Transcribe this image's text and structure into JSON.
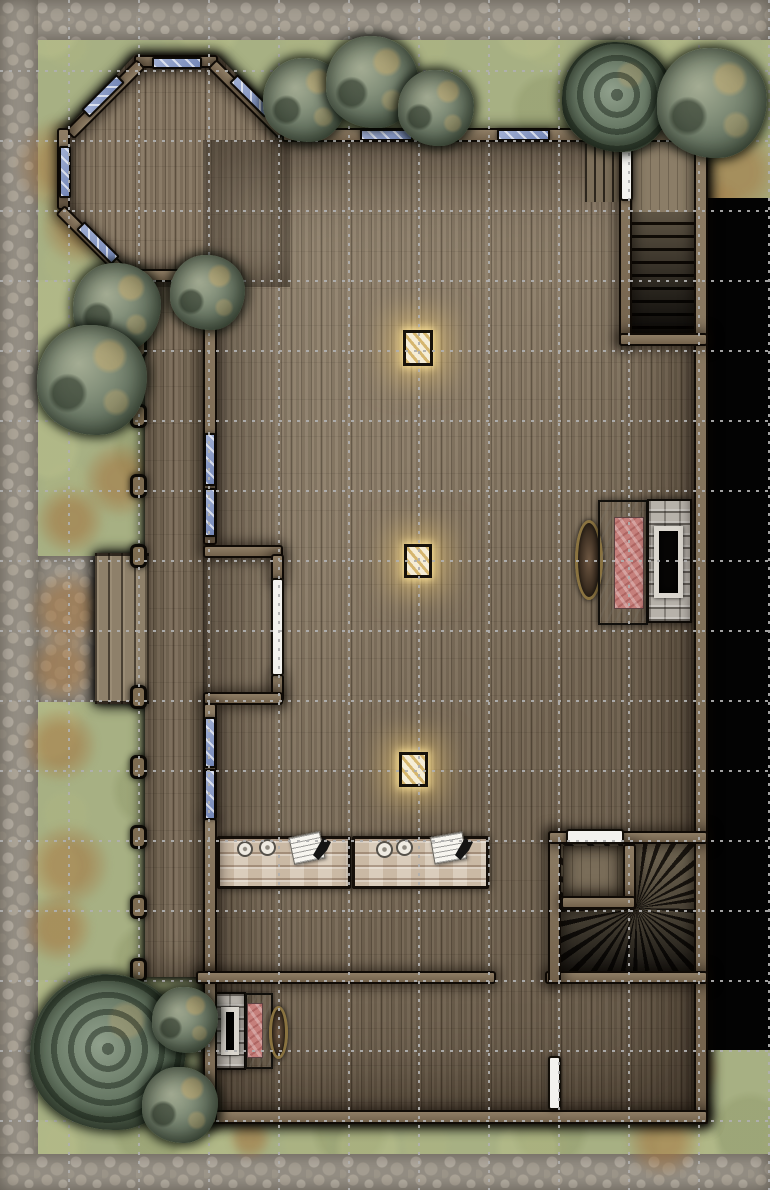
{
  "map": {
    "kind": "top-down fantasy battle map of a wooden manor interior",
    "size": {
      "width": 770,
      "height": 1190
    },
    "grid": {
      "cell": 70,
      "first_vertical_x": 68,
      "first_horizontal_y": 70,
      "width": 770,
      "height": 1190,
      "color": "#b0b0b0",
      "style": "dotted"
    },
    "palette": {
      "grass": "#a7b083",
      "stone_path": "#948e84",
      "dirt": "#a4743e",
      "wood_floor": "#82735f",
      "wall": "#7e6d55",
      "window_glass": "#8ea0c8",
      "door": "#f3f2ee",
      "table_wood": "#d5c6b3",
      "blanket_red": "#c57f7b",
      "void_black": "#030303",
      "lantern_glow": "#ffd878",
      "tree_green": "#6d7b68"
    },
    "summary": {
      "windows": 11,
      "doors": 4,
      "lanterns": 3,
      "tables": 2,
      "fireplaces_with_beds": 2,
      "trees_and_bushes": 12,
      "porch_posts": 10,
      "straight_staircase": 1,
      "winder_staircase": 1,
      "octagonal_bay": 1
    },
    "layers": {
      "stone": [
        {
          "name": "stone-path-top",
          "x": 0,
          "y": 0,
          "w": 770,
          "h": 40
        },
        {
          "name": "stone-path-left",
          "x": 0,
          "y": 0,
          "w": 38,
          "h": 1190
        },
        {
          "name": "stone-path-bottom",
          "x": 0,
          "y": 1154,
          "w": 770,
          "h": 36
        },
        {
          "name": "stone-walkway",
          "x": 38,
          "y": 556,
          "w": 58,
          "h": 146
        }
      ],
      "dirt": [
        {
          "name": "dirt-patch",
          "x": 14,
          "y": 117,
          "w": 96,
          "h": 96
        },
        {
          "name": "dirt-patch",
          "x": 40,
          "y": 185,
          "w": 80,
          "h": 80
        },
        {
          "name": "dirt-patch",
          "x": 75,
          "y": 185,
          "w": 60,
          "h": 60
        },
        {
          "name": "dirt-patch",
          "x": 687,
          "y": 124,
          "w": 96,
          "h": 96
        },
        {
          "name": "dirt-patch",
          "x": 677,
          "y": 180,
          "w": 70,
          "h": 70
        },
        {
          "name": "dirt-patch",
          "x": 82,
          "y": 442,
          "w": 76,
          "h": 76
        },
        {
          "name": "dirt-patch",
          "x": 35,
          "y": 485,
          "w": 70,
          "h": 70
        },
        {
          "name": "dirt-patch",
          "x": 28,
          "y": 570,
          "w": 80,
          "h": 80
        },
        {
          "name": "dirt-patch",
          "x": 27,
          "y": 633,
          "w": 70,
          "h": 70
        },
        {
          "name": "dirt-patch",
          "x": 22,
          "y": 707,
          "w": 76,
          "h": 76
        },
        {
          "name": "dirt-patch",
          "x": 26,
          "y": 823,
          "w": 84,
          "h": 84
        },
        {
          "name": "dirt-patch",
          "x": 23,
          "y": 893,
          "w": 70,
          "h": 70
        },
        {
          "name": "dirt-patch",
          "x": 625,
          "y": 1102,
          "w": 76,
          "h": 76
        },
        {
          "name": "dirt-patch",
          "x": 664,
          "y": 1040,
          "w": 56,
          "h": 56
        },
        {
          "name": "dirt-patch",
          "x": 228,
          "y": 1116,
          "w": 44,
          "h": 44
        }
      ],
      "floors": [
        {
          "name": "floor-bay",
          "cls": "floor",
          "x": 57,
          "y": 55,
          "w": 233,
          "h": 232,
          "clip": "polygon(78px 0px,160px 0px,233px 73px,233px 232px,92px 232px,92px 222px,70px 222px,8px 150px,8px 76px)"
        },
        {
          "name": "floor-great-hall",
          "cls": "floor",
          "x": 203,
          "y": 140,
          "w": 505,
          "h": 984
        },
        {
          "name": "floor-porch-deck",
          "cls": "floor",
          "x": 145,
          "y": 275,
          "w": 62,
          "h": 702
        },
        {
          "name": "porch-steps",
          "cls": "steps-porch",
          "x": 95,
          "y": 553,
          "w": 54,
          "h": 151
        }
      ],
      "void": [
        {
          "name": "unexplored-void",
          "cls": "void",
          "x": 706,
          "y": 198,
          "w": 64,
          "h": 852
        }
      ],
      "shades": [
        {
          "name": "hall-lighting",
          "cls": "shade-hall",
          "x": 203,
          "y": 140,
          "w": 505,
          "h": 984
        },
        {
          "name": "deck-shading",
          "cls": "shade-soft",
          "x": 145,
          "y": 275,
          "w": 62,
          "h": 702
        },
        {
          "name": "bay-shading",
          "cls": "shade-soft",
          "x": 57,
          "y": 55,
          "w": 233,
          "h": 232,
          "clip": "polygon(78px 0px,160px 0px,233px 73px,233px 232px,92px 232px,92px 222px,70px 222px,8px 150px,8px 76px)"
        }
      ],
      "stairs": [
        {
          "name": "stair-side-steps",
          "cls": "stairs-side",
          "x": 585,
          "y": 144,
          "w": 36,
          "h": 58
        },
        {
          "name": "stair-landing",
          "cls": "stairs-landing",
          "x": 632,
          "y": 142,
          "w": 62,
          "h": 70
        },
        {
          "name": "staircase-down",
          "cls": "stairs-steps",
          "x": 632,
          "y": 212,
          "w": 62,
          "h": 121
        },
        {
          "name": "winder-staircase",
          "cls": "fan",
          "x": 561,
          "y": 844,
          "w": 137,
          "h": 128
        },
        {
          "name": "closet-floor",
          "cls": "closet-floor",
          "x": 563,
          "y": 846,
          "w": 60,
          "h": 50
        }
      ],
      "furniture": [
        {
          "name": "long-table",
          "cls": "table",
          "x": 217,
          "y": 836,
          "w": 134,
          "h": 53
        },
        {
          "name": "long-table",
          "cls": "table",
          "x": 352,
          "y": 836,
          "w": 137,
          "h": 53
        },
        {
          "name": "plate",
          "cls": "plate",
          "x": 237,
          "y": 841,
          "w": 16,
          "h": 16
        },
        {
          "name": "plate",
          "cls": "plate",
          "x": 259,
          "y": 839,
          "w": 17,
          "h": 17
        },
        {
          "name": "plate",
          "cls": "plate",
          "x": 376,
          "y": 841,
          "w": 17,
          "h": 17
        },
        {
          "name": "plate",
          "cls": "plate",
          "x": 396,
          "y": 839,
          "w": 17,
          "h": 17
        },
        {
          "name": "papers",
          "cls": "paper",
          "x": 291,
          "y": 834,
          "w": 32,
          "h": 28,
          "rot": -12
        },
        {
          "name": "papers",
          "cls": "paper",
          "x": 432,
          "y": 834,
          "w": 33,
          "h": 28,
          "rot": -10
        },
        {
          "name": "quill",
          "cls": "quill",
          "x": 313,
          "y": 838,
          "w": 18,
          "h": 22
        },
        {
          "name": "quill",
          "cls": "quill",
          "x": 455,
          "y": 838,
          "w": 18,
          "h": 22
        },
        {
          "name": "wall-ornament",
          "cls": "decor",
          "x": 575,
          "y": 520,
          "w": 28,
          "h": 80
        },
        {
          "name": "bed-frame",
          "cls": "bedframe",
          "x": 598,
          "y": 500,
          "w": 50,
          "h": 125
        },
        {
          "name": "red-blanket",
          "cls": "blanket",
          "x": 614,
          "y": 517,
          "w": 30,
          "h": 92
        },
        {
          "name": "stone-fireplace",
          "cls": "hearth",
          "x": 647,
          "y": 499,
          "w": 45,
          "h": 124
        },
        {
          "name": "hearth-opening",
          "cls": "hearth-open",
          "x": 654,
          "y": 526,
          "w": 29,
          "h": 72
        },
        {
          "name": "stone-fireplace",
          "cls": "hearth",
          "x": 212,
          "y": 992,
          "w": 34,
          "h": 78
        },
        {
          "name": "hearth-opening",
          "cls": "hearth-open",
          "x": 221,
          "y": 1007,
          "w": 18,
          "h": 48
        },
        {
          "name": "bed-frame",
          "cls": "bedframe",
          "x": 245,
          "y": 993,
          "w": 28,
          "h": 76
        },
        {
          "name": "red-blanket",
          "cls": "blanket",
          "x": 247,
          "y": 1003,
          "w": 16,
          "h": 55
        },
        {
          "name": "wall-ornament",
          "cls": "decor",
          "x": 269,
          "y": 1006,
          "w": 19,
          "h": 53
        },
        {
          "name": "glowing-lantern",
          "cls": "lantern",
          "x": 403,
          "y": 330,
          "w": 30,
          "h": 36
        },
        {
          "name": "glowing-lantern",
          "cls": "lantern",
          "x": 404,
          "y": 544,
          "w": 28,
          "h": 34
        },
        {
          "name": "glowing-lantern",
          "cls": "lantern",
          "x": 399,
          "y": 752,
          "w": 29,
          "h": 35
        }
      ],
      "walls": [
        {
          "name": "bay-wall-north",
          "x": 134,
          "y": 55,
          "w": 84,
          "h": 13
        },
        {
          "name": "bay-wall-ne-diagonal",
          "x": 212,
          "y": 57,
          "w": 101,
          "h": 13,
          "rot": 45,
          "origin": "0 50%"
        },
        {
          "name": "bay-wall-nw-diagonal",
          "x": 141,
          "y": 57,
          "w": 101,
          "h": 13,
          "rot": 135,
          "origin": "0 50%"
        },
        {
          "name": "bay-wall-west",
          "x": 57,
          "y": 128,
          "w": 13,
          "h": 82
        },
        {
          "name": "bay-wall-sw-diagonal",
          "x": 60,
          "y": 203,
          "w": 100,
          "h": 13,
          "rot": 45,
          "origin": "0 50%"
        },
        {
          "name": "bay-wall-south",
          "x": 126,
          "y": 269,
          "w": 90,
          "h": 13
        },
        {
          "name": "north-wall",
          "x": 282,
          "y": 128,
          "w": 426,
          "h": 14
        },
        {
          "name": "east-wall",
          "x": 694,
          "y": 128,
          "w": 14,
          "h": 996
        },
        {
          "name": "south-wall",
          "x": 196,
          "y": 1110,
          "w": 512,
          "h": 14
        },
        {
          "name": "west-wall-upper",
          "x": 203,
          "y": 275,
          "w": 14,
          "h": 270
        },
        {
          "name": "alcove-wall-top",
          "x": 203,
          "y": 545,
          "w": 80,
          "h": 13
        },
        {
          "name": "alcove-door-jamb",
          "x": 271,
          "y": 554,
          "w": 13,
          "h": 28
        },
        {
          "name": "alcove-door-jamb",
          "x": 271,
          "y": 674,
          "w": 13,
          "h": 28
        },
        {
          "name": "alcove-wall-bottom",
          "x": 203,
          "y": 692,
          "w": 80,
          "h": 13
        },
        {
          "name": "west-wall-mid",
          "x": 203,
          "y": 703,
          "w": 14,
          "h": 117
        },
        {
          "name": "west-wall-lower",
          "x": 203,
          "y": 818,
          "w": 14,
          "h": 157
        },
        {
          "name": "storeroom-west-wall",
          "x": 203,
          "y": 972,
          "w": 14,
          "h": 152
        },
        {
          "name": "cross-wall-west",
          "x": 196,
          "y": 971,
          "w": 300,
          "h": 13
        },
        {
          "name": "cross-wall-east",
          "x": 545,
          "y": 971,
          "w": 163,
          "h": 13
        },
        {
          "name": "stairroom-west-wall",
          "x": 548,
          "y": 831,
          "w": 13,
          "h": 153
        },
        {
          "name": "stairroom-north-wall",
          "x": 548,
          "y": 831,
          "w": 160,
          "h": 13
        },
        {
          "name": "closet-east-wall",
          "x": 623,
          "y": 844,
          "w": 13,
          "h": 66
        },
        {
          "name": "closet-south-wall",
          "x": 561,
          "y": 896,
          "w": 75,
          "h": 13
        },
        {
          "name": "stairshaft-west-wall",
          "x": 619,
          "y": 128,
          "w": 13,
          "h": 218
        },
        {
          "name": "stairshaft-south-wall",
          "x": 619,
          "y": 333,
          "w": 89,
          "h": 13
        }
      ],
      "doors": [
        {
          "name": "door-west-alcove",
          "cls": "door",
          "x": 271,
          "y": 578,
          "w": 13,
          "h": 98
        },
        {
          "name": "door-stair-landing",
          "cls": "door",
          "x": 620,
          "y": 144,
          "w": 13,
          "h": 57
        },
        {
          "name": "door-stair-room",
          "cls": "door",
          "x": 566,
          "y": 829,
          "w": 58,
          "h": 15
        },
        {
          "name": "door-store-room",
          "cls": "door",
          "x": 548,
          "y": 1056,
          "w": 13,
          "h": 54
        }
      ],
      "windows": [
        {
          "name": "window",
          "x": 152,
          "y": 57,
          "w": 50,
          "h": 12
        },
        {
          "name": "window",
          "x": 226,
          "y": 90,
          "w": 50,
          "h": 12,
          "rot": 45
        },
        {
          "name": "window",
          "x": 78,
          "y": 90,
          "w": 50,
          "h": 12,
          "rot": -45
        },
        {
          "name": "window",
          "x": 59,
          "y": 146,
          "w": 12,
          "h": 52
        },
        {
          "name": "window",
          "x": 73,
          "y": 237,
          "w": 50,
          "h": 12,
          "rot": 45
        },
        {
          "name": "window",
          "x": 360,
          "y": 129,
          "w": 53,
          "h": 12
        },
        {
          "name": "window",
          "x": 497,
          "y": 129,
          "w": 53,
          "h": 12
        },
        {
          "name": "window",
          "x": 204,
          "y": 433,
          "w": 12,
          "h": 53
        },
        {
          "name": "window",
          "x": 204,
          "y": 488,
          "w": 12,
          "h": 49
        },
        {
          "name": "window",
          "x": 204,
          "y": 717,
          "w": 12,
          "h": 51
        },
        {
          "name": "window",
          "x": 204,
          "y": 769,
          "w": 12,
          "h": 51
        }
      ],
      "posts": [
        {
          "name": "porch-post",
          "x": 130,
          "y": 283,
          "w": 17,
          "h": 24
        },
        {
          "name": "porch-post",
          "x": 130,
          "y": 334,
          "w": 17,
          "h": 24
        },
        {
          "name": "porch-post",
          "x": 130,
          "y": 404,
          "w": 17,
          "h": 24
        },
        {
          "name": "porch-post",
          "x": 130,
          "y": 474,
          "w": 17,
          "h": 24
        },
        {
          "name": "porch-post",
          "x": 130,
          "y": 544,
          "w": 17,
          "h": 24
        },
        {
          "name": "porch-post",
          "x": 130,
          "y": 685,
          "w": 17,
          "h": 24
        },
        {
          "name": "porch-post",
          "x": 130,
          "y": 755,
          "w": 17,
          "h": 24
        },
        {
          "name": "porch-post",
          "x": 130,
          "y": 825,
          "w": 17,
          "h": 24
        },
        {
          "name": "porch-post",
          "x": 130,
          "y": 895,
          "w": 17,
          "h": 24
        },
        {
          "name": "porch-post",
          "x": 130,
          "y": 958,
          "w": 17,
          "h": 24
        }
      ],
      "trees": [
        {
          "name": "bush",
          "cls": "tree bush",
          "x": 263,
          "y": 58,
          "w": 84,
          "h": 84
        },
        {
          "name": "bush",
          "cls": "tree bush",
          "x": 326,
          "y": 36,
          "w": 92,
          "h": 92
        },
        {
          "name": "bush",
          "cls": "tree bush",
          "x": 398,
          "y": 70,
          "w": 76,
          "h": 76
        },
        {
          "name": "tree",
          "cls": "tree swirl",
          "x": 562,
          "y": 42,
          "w": 110,
          "h": 110
        },
        {
          "name": "bush",
          "cls": "tree bush",
          "x": 657,
          "y": 48,
          "w": 110,
          "h": 110
        },
        {
          "name": "bush",
          "cls": "tree bush",
          "x": 73,
          "y": 263,
          "w": 88,
          "h": 88
        },
        {
          "name": "bush",
          "cls": "tree bush",
          "x": 170,
          "y": 255,
          "w": 75,
          "h": 75
        },
        {
          "name": "bush",
          "cls": "tree bush",
          "x": 37,
          "y": 325,
          "w": 110,
          "h": 110
        },
        {
          "name": "tree",
          "cls": "tree swirl",
          "x": 30,
          "y": 974,
          "w": 156,
          "h": 156
        },
        {
          "name": "bush",
          "cls": "tree bush",
          "x": 152,
          "y": 987,
          "w": 66,
          "h": 66
        },
        {
          "name": "bush",
          "cls": "tree bush",
          "x": 142,
          "y": 1067,
          "w": 76,
          "h": 76
        }
      ]
    }
  }
}
